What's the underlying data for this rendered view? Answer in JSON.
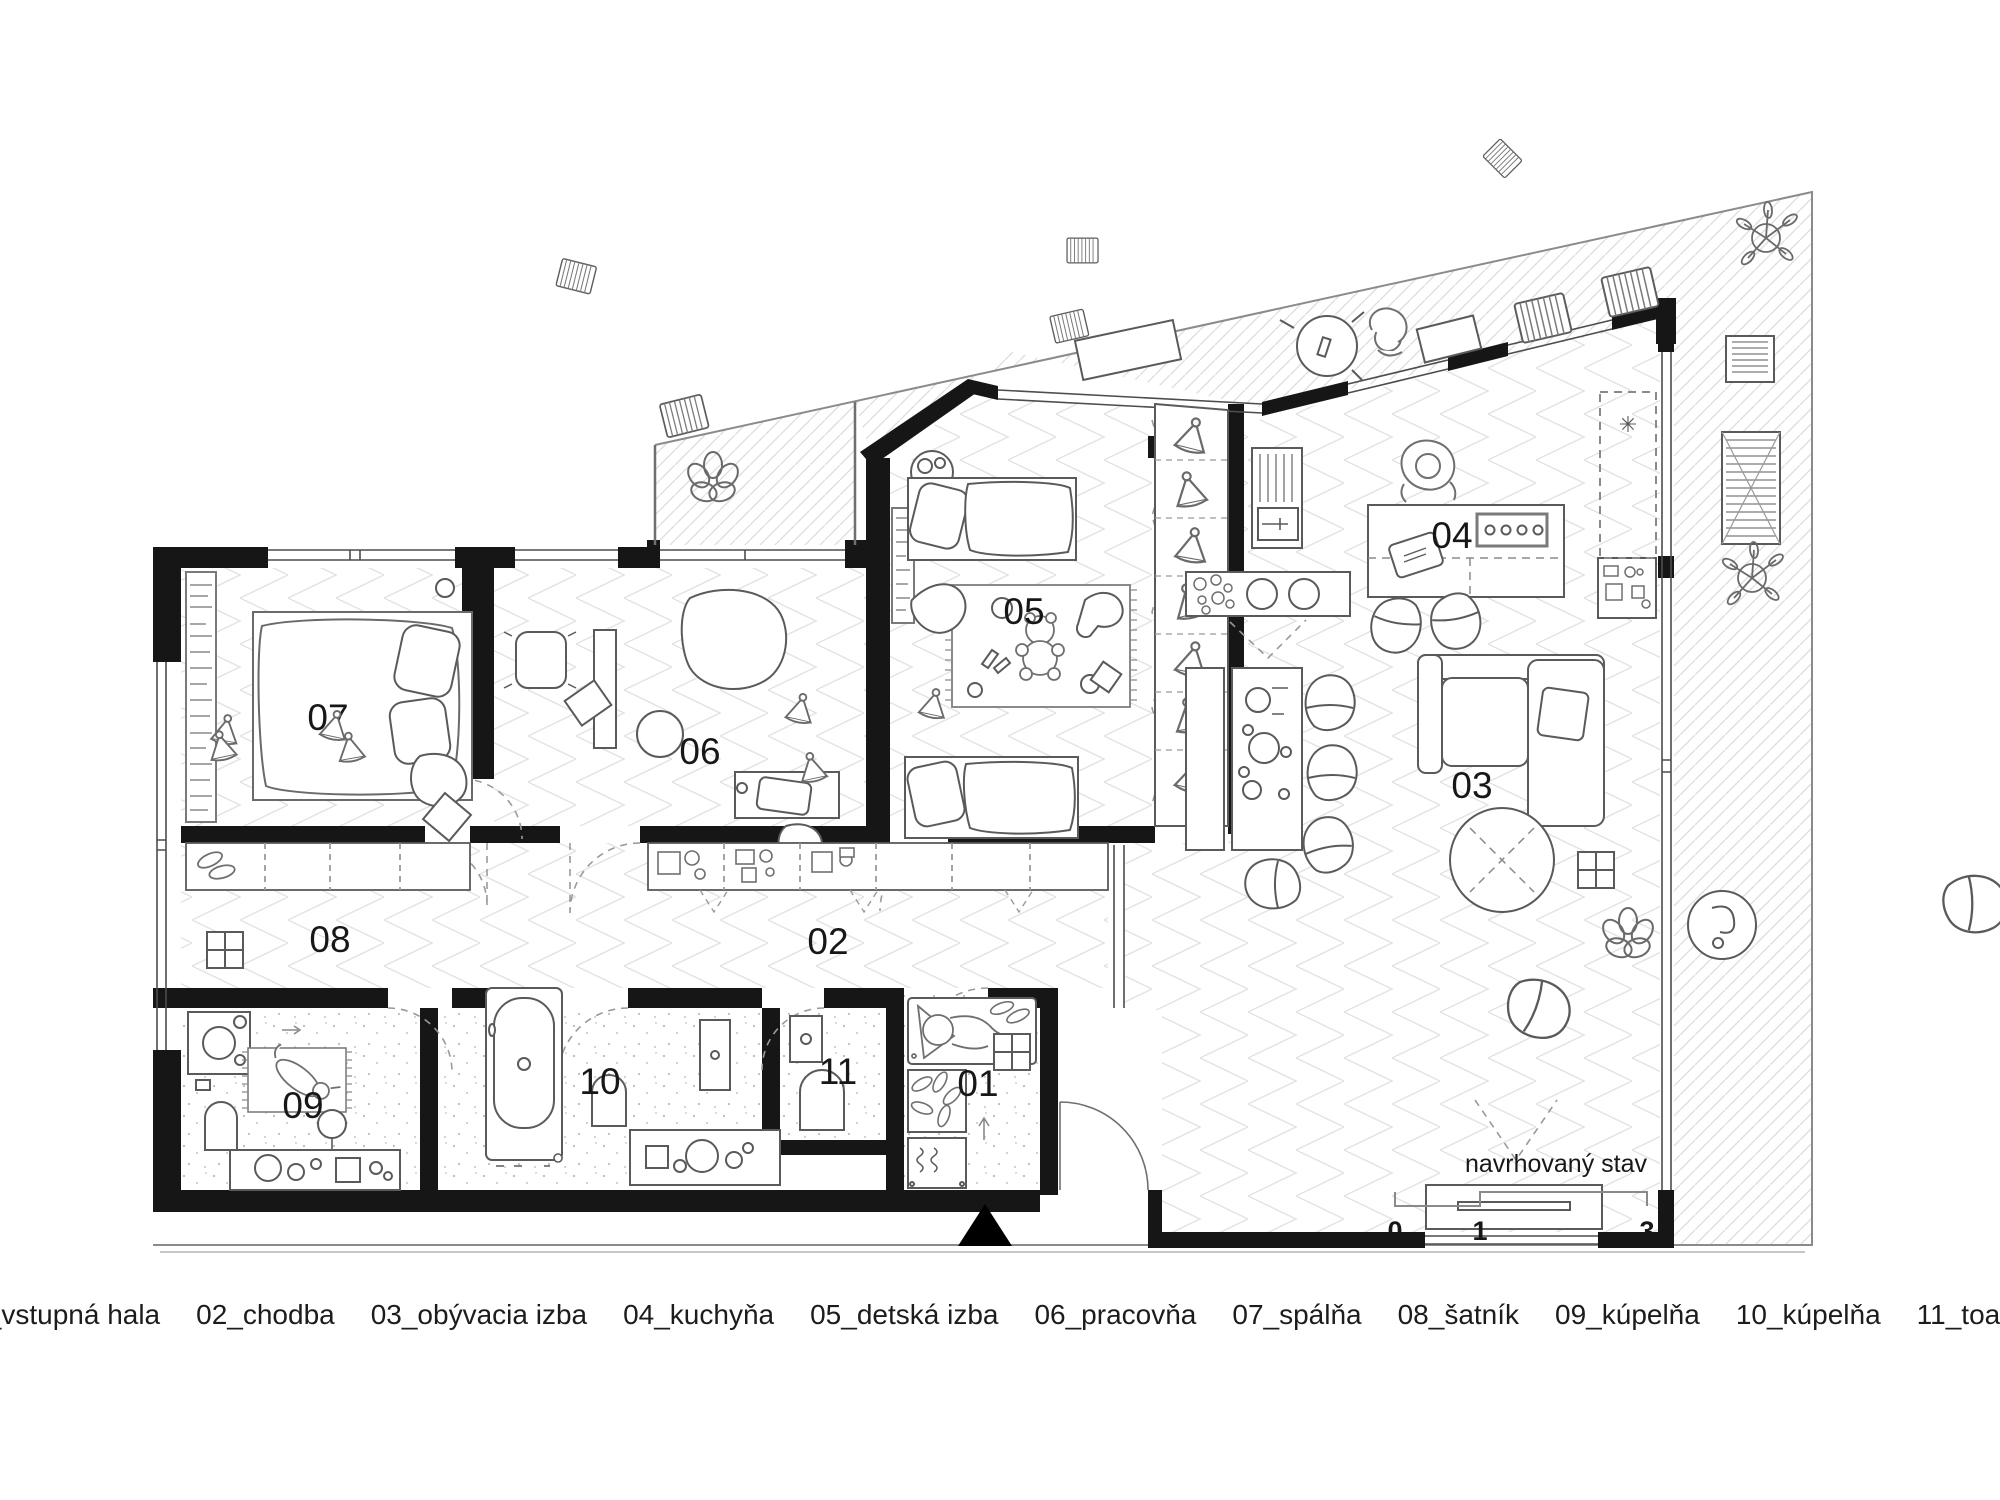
{
  "plan": {
    "annotation": "navrhovaný stav",
    "scale_ticks": [
      "0",
      "1",
      "3"
    ],
    "rooms": [
      {
        "num": "01",
        "name": "vstupná hala",
        "legend": "01_vstupná hala"
      },
      {
        "num": "02",
        "name": "chodba",
        "legend": "02_chodba"
      },
      {
        "num": "03",
        "name": "obývacia izba",
        "legend": "03_obývacia izba"
      },
      {
        "num": "04",
        "name": "kuchyňa",
        "legend": "04_kuchyňa"
      },
      {
        "num": "05",
        "name": "detská izba",
        "legend": "05_detská izba"
      },
      {
        "num": "06",
        "name": "pracovňa",
        "legend": "06_pracovňa"
      },
      {
        "num": "07",
        "name": "spálňa",
        "legend": "07_spálňa"
      },
      {
        "num": "08",
        "name": "šatník",
        "legend": "08_šatník"
      },
      {
        "num": "09",
        "name": "kúpelňa",
        "legend": "09_kúpelňa"
      },
      {
        "num": "10",
        "name": "kúpelňa",
        "legend": "10_kúpelňa"
      },
      {
        "num": "11",
        "name": "toaleta",
        "legend": "11_toaleta"
      }
    ],
    "symbols": {
      "wardrobe_marker": "✳"
    },
    "colors": {
      "wall": "#161616",
      "furniture_line": "#5a5a5a",
      "hatch": "#dedede",
      "paper": "#ffffff"
    }
  }
}
